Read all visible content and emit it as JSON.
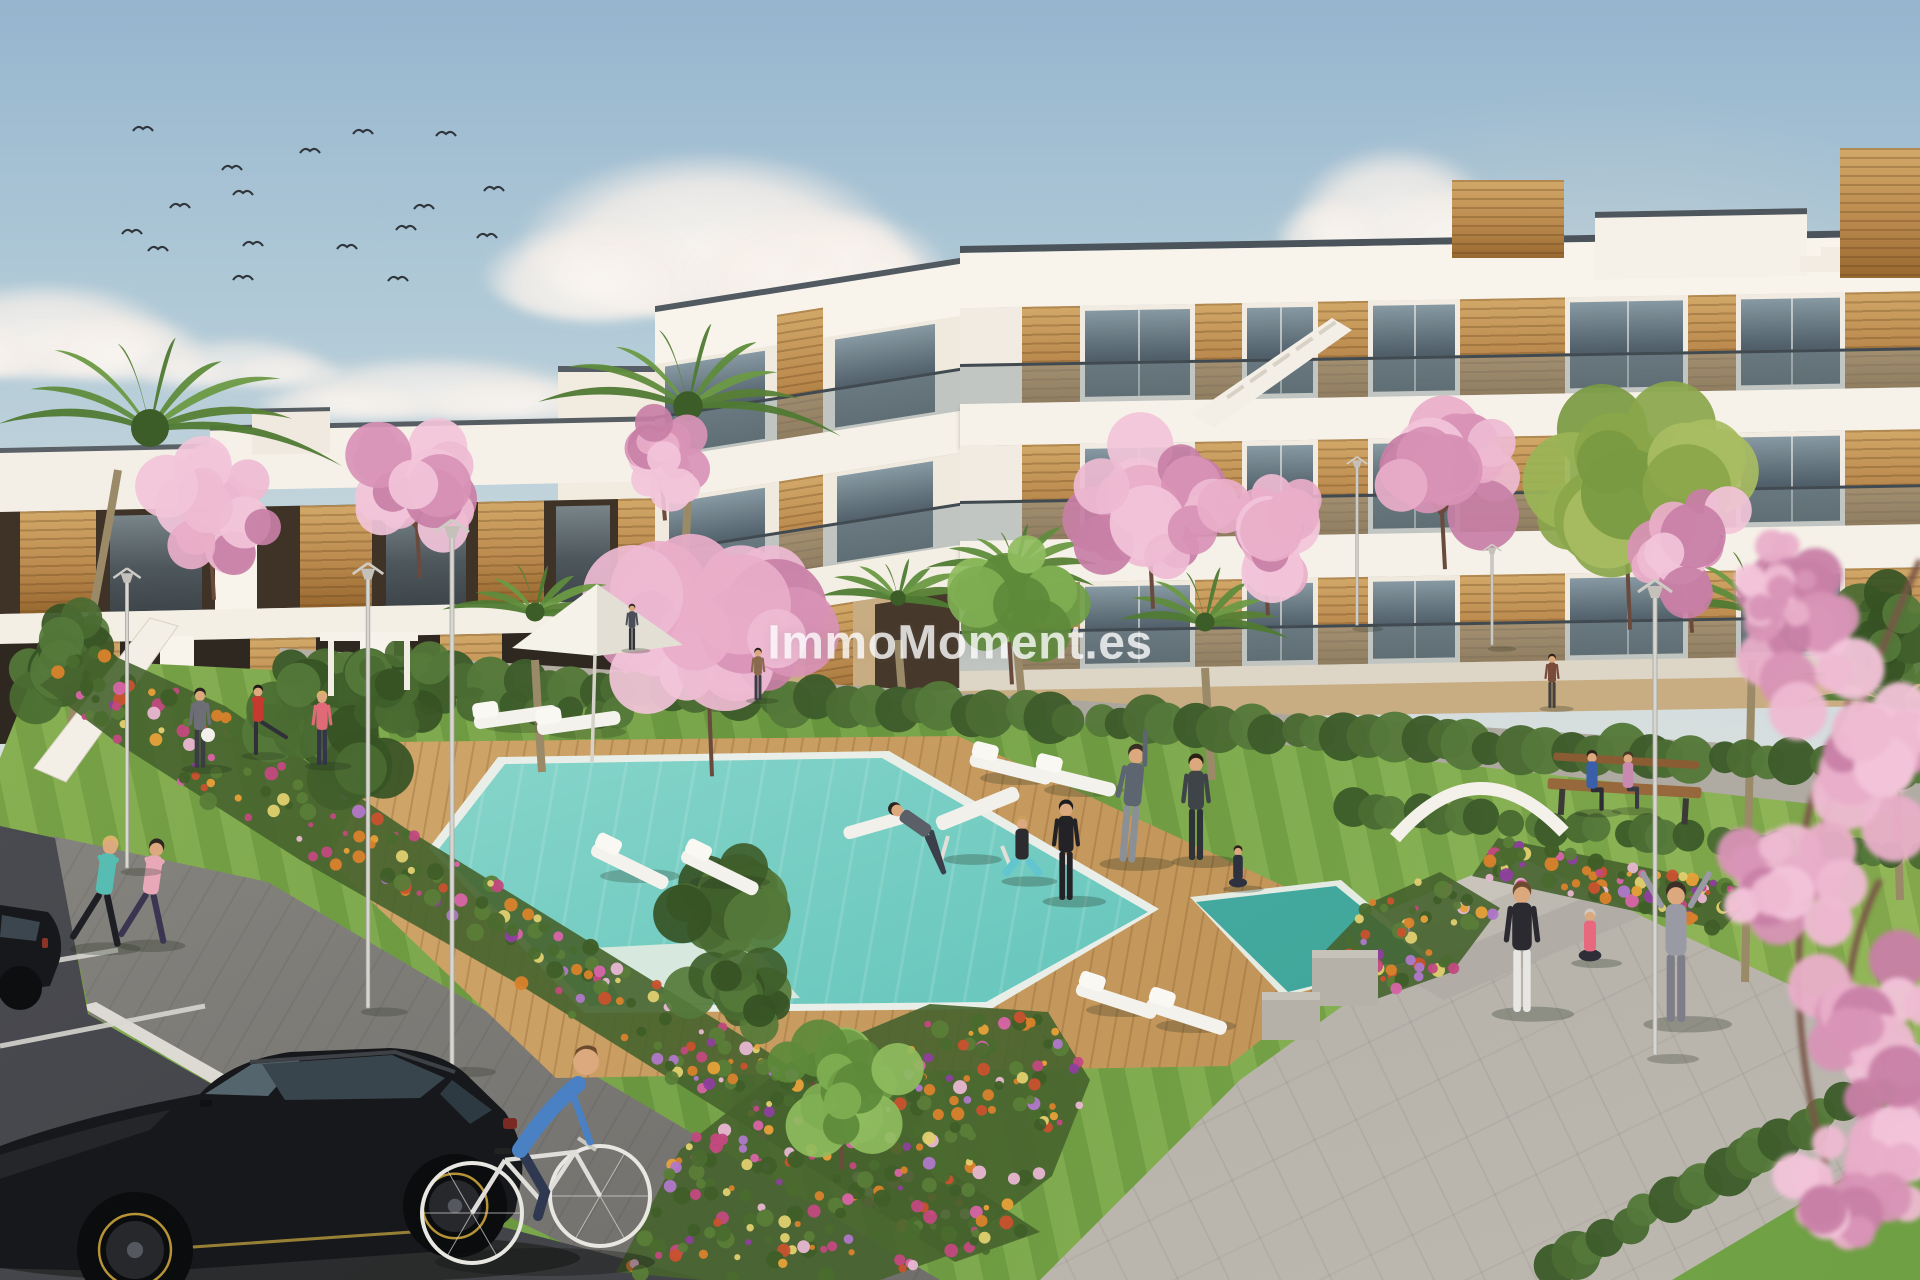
{
  "watermark": {
    "text": "ImmoMoment.es"
  },
  "scene_labels": {
    "setting": "new-build apartment complex render with communal pool and gardens",
    "objects": [
      "apartment-buildings",
      "swimming-pool",
      "wood-deck",
      "sun-loungers",
      "parasol",
      "lawn",
      "flower-beds",
      "cherry-blossom-trees",
      "palm-trees",
      "street-lamps",
      "joggers",
      "cyclist",
      "yoga-group",
      "bench-couple",
      "black-car",
      "parking-lot",
      "birds",
      "clouds"
    ]
  },
  "palette": {
    "sky_top": "#96b5ce",
    "sky_bottom": "#efe9df",
    "building_white": "#f8f4ec",
    "wood": "#bb8a4e",
    "glass": "#51606a",
    "lawn": "#74a246",
    "pool": "#62c4ba",
    "deck": "#c69a5e",
    "path": "#9a9792",
    "asphalt": "#44454a",
    "flower_magenta": "#c2497f",
    "flower_orange": "#d9822b",
    "blossom_pink": "#e9aec9"
  },
  "birds": [
    [
      143,
      128
    ],
    [
      310,
      150
    ],
    [
      363,
      131
    ],
    [
      446,
      133
    ],
    [
      232,
      167
    ],
    [
      180,
      205
    ],
    [
      494,
      188
    ],
    [
      424,
      206
    ],
    [
      243,
      192
    ],
    [
      132,
      231
    ],
    [
      253,
      243
    ],
    [
      347,
      246
    ],
    [
      406,
      227
    ],
    [
      158,
      248
    ],
    [
      487,
      235
    ],
    [
      243,
      277
    ],
    [
      398,
      278
    ]
  ],
  "clouds": [
    {
      "x": 710,
      "y": 235,
      "w": 380,
      "h": 165,
      "o": 0.97
    },
    {
      "x": 45,
      "y": 330,
      "w": 260,
      "h": 95,
      "o": 0.9
    },
    {
      "x": 435,
      "y": 388,
      "w": 300,
      "h": 62,
      "o": 0.8
    },
    {
      "x": 852,
      "y": 258,
      "w": 120,
      "h": 85,
      "o": 0.85
    },
    {
      "x": 1395,
      "y": 208,
      "w": 200,
      "h": 120,
      "o": 0.9
    },
    {
      "x": 240,
      "y": 362,
      "w": 170,
      "h": 48,
      "o": 0.7
    },
    {
      "x": 1060,
      "y": 372,
      "w": 260,
      "h": 50,
      "o": 0.6
    }
  ],
  "palms": [
    {
      "cx": 150,
      "cy": 428,
      "r": 190,
      "trunk": [
        [
          118,
          470
        ],
        [
          96,
          600
        ],
        [
          62,
          770
        ]
      ],
      "layer": "mid"
    },
    {
      "cx": 688,
      "cy": 406,
      "r": 148,
      "trunk": [
        [
          688,
          470
        ],
        [
          688,
          520
        ],
        [
          684,
          560
        ]
      ],
      "layer": "mid"
    },
    {
      "cx": 898,
      "cy": 598,
      "r": 78,
      "trunk": [
        [
          898,
          640
        ],
        [
          900,
          668
        ],
        [
          902,
          690
        ]
      ],
      "layer": "mid"
    },
    {
      "cx": 1015,
      "cy": 570,
      "r": 92,
      "trunk": [
        [
          1015,
          620
        ],
        [
          1018,
          660
        ],
        [
          1022,
          700
        ]
      ],
      "layer": "mid"
    },
    {
      "cx": 1205,
      "cy": 622,
      "r": 95,
      "trunk": [
        [
          1205,
          668
        ],
        [
          1208,
          724
        ],
        [
          1212,
          780
        ]
      ],
      "layer": "mid"
    },
    {
      "cx": 1755,
      "cy": 610,
      "r": 108,
      "trunk": [
        [
          1752,
          660
        ],
        [
          1748,
          820
        ],
        [
          1745,
          982
        ]
      ],
      "layer": "mid"
    },
    {
      "cx": 1895,
      "cy": 705,
      "r": 115,
      "trunk": [
        [
          1895,
          760
        ],
        [
          1898,
          830
        ],
        [
          1900,
          900
        ]
      ],
      "layer": "mid"
    },
    {
      "cx": 535,
      "cy": 612,
      "r": 95,
      "trunk": [
        [
          535,
          660
        ],
        [
          538,
          715
        ],
        [
          542,
          772
        ]
      ],
      "layer": "front"
    }
  ],
  "blossoms": [
    {
      "cx": 214,
      "cy": 510,
      "r": 78,
      "layer": "mid"
    },
    {
      "cx": 420,
      "cy": 486,
      "r": 80,
      "layer": "mid"
    },
    {
      "cx": 665,
      "cy": 456,
      "r": 56,
      "layer": "mid"
    },
    {
      "cx": 1153,
      "cy": 503,
      "r": 92,
      "layer": "mid"
    },
    {
      "cx": 1268,
      "cy": 528,
      "r": 76,
      "layer": "mid"
    },
    {
      "cx": 1445,
      "cy": 468,
      "r": 88,
      "layer": "mid"
    },
    {
      "cx": 1692,
      "cy": 543,
      "r": 78,
      "layer": "mid"
    },
    {
      "cx": 712,
      "cy": 636,
      "r": 122,
      "layer": "front"
    }
  ],
  "fg_blossoms": [
    {
      "cx": 1810,
      "cy": 640,
      "r": 92
    },
    {
      "cx": 1878,
      "cy": 762,
      "r": 104
    },
    {
      "cx": 1788,
      "cy": 905,
      "r": 88
    },
    {
      "cx": 1862,
      "cy": 1012,
      "r": 98
    },
    {
      "cx": 1905,
      "cy": 1140,
      "r": 95
    },
    {
      "cx": 1830,
      "cy": 1208,
      "r": 82
    },
    {
      "cx": 1772,
      "cy": 585,
      "r": 55
    }
  ],
  "green_trees": [
    {
      "cx": 1630,
      "cy": 494,
      "r": 118,
      "shade": "yellow",
      "layer": "mid"
    },
    {
      "cx": 1012,
      "cy": 597,
      "r": 76,
      "shade": "light",
      "layer": "mid"
    },
    {
      "cx": 842,
      "cy": 1082,
      "r": 76,
      "shade": "light",
      "layer": "front"
    },
    {
      "cx": 330,
      "cy": 736,
      "r": 88,
      "shade": "dark",
      "layer": "front"
    },
    {
      "cx": 398,
      "cy": 688,
      "r": 58,
      "shade": "dark",
      "layer": "front"
    },
    {
      "cx": 728,
      "cy": 898,
      "r": 80,
      "shade": "dark",
      "layer": "front"
    },
    {
      "cx": 738,
      "cy": 990,
      "r": 66,
      "shade": "dark",
      "layer": "front"
    },
    {
      "cx": 60,
      "cy": 660,
      "r": 70,
      "shade": "dark",
      "layer": "mid"
    },
    {
      "cx": 1880,
      "cy": 640,
      "r": 72,
      "shade": "dark",
      "layer": "mid"
    }
  ],
  "hedges": [
    {
      "x1": 295,
      "y1": 668,
      "x2": 1920,
      "y2": 772,
      "r": 21,
      "n": 66
    },
    {
      "x1": 1350,
      "y1": 810,
      "x2": 1920,
      "y2": 858,
      "r": 16,
      "n": 26
    },
    {
      "x1": 1552,
      "y1": 1268,
      "x2": 1880,
      "y2": 1082,
      "r": 20,
      "n": 18
    },
    {
      "x1": 380,
      "y1": 700,
      "x2": 620,
      "y2": 716,
      "r": 14,
      "n": 12
    }
  ],
  "lamps": [
    {
      "x": 127,
      "top": 562,
      "bot": 868,
      "s": 0.8,
      "layer": "front"
    },
    {
      "x": 368,
      "top": 556,
      "bot": 1008,
      "s": 0.9,
      "layer": "front"
    },
    {
      "x": 452,
      "top": 512,
      "bot": 1068,
      "s": 1.0,
      "layer": "front"
    },
    {
      "x": 1357,
      "top": 452,
      "bot": 625,
      "s": 0.6,
      "layer": "mid"
    },
    {
      "x": 1492,
      "top": 540,
      "bot": 645,
      "s": 0.55,
      "layer": "mid"
    },
    {
      "x": 1655,
      "top": 572,
      "bot": 1055,
      "s": 1.0,
      "layer": "front"
    }
  ],
  "loungers": [
    {
      "x": 515,
      "y": 712,
      "rot": -8
    },
    {
      "x": 578,
      "y": 718,
      "rot": -8
    },
    {
      "x": 1012,
      "y": 764,
      "rot": 14
    },
    {
      "x": 1076,
      "y": 776,
      "rot": 14
    },
    {
      "x": 632,
      "y": 862,
      "rot": 26
    },
    {
      "x": 722,
      "y": 868,
      "rot": 26
    },
    {
      "x": 1118,
      "y": 996,
      "rot": 18
    },
    {
      "x": 1188,
      "y": 1012,
      "rot": 18
    }
  ],
  "flowerbeds": [
    {
      "name": "bed-left",
      "count": 270,
      "poly": [
        [
          92,
          646
        ],
        [
          225,
          706
        ],
        [
          405,
          828
        ],
        [
          765,
          1050
        ],
        [
          1040,
          1232
        ],
        [
          955,
          1262
        ],
        [
          760,
          1135
        ],
        [
          520,
          985
        ],
        [
          300,
          860
        ],
        [
          120,
          745
        ],
        [
          40,
          685
        ]
      ]
    },
    {
      "name": "bed-center",
      "count": 250,
      "poly": [
        [
          616,
          1272
        ],
        [
          680,
          1150
        ],
        [
          790,
          1062
        ],
        [
          930,
          1004
        ],
        [
          1048,
          1012
        ],
        [
          1090,
          1080
        ],
        [
          1052,
          1176
        ],
        [
          950,
          1255
        ],
        [
          880,
          1280
        ],
        [
          700,
          1280
        ]
      ]
    },
    {
      "name": "bed-steps",
      "count": 60,
      "poly": [
        [
          1318,
          958
        ],
        [
          1372,
          902
        ],
        [
          1440,
          872
        ],
        [
          1500,
          908
        ],
        [
          1452,
          972
        ],
        [
          1368,
          1002
        ]
      ]
    },
    {
      "name": "bed-right",
      "count": 90,
      "poly": [
        [
          1498,
          838
        ],
        [
          1758,
          890
        ],
        [
          1722,
          930
        ],
        [
          1472,
          876
        ]
      ]
    }
  ],
  "people": [
    {
      "x": 96,
      "y": 947,
      "h": 112,
      "pose": "run",
      "shirt": "#57bdb2",
      "pants": "#1e1f24",
      "hair": "#d8b36a"
    },
    {
      "x": 143,
      "y": 944,
      "h": 106,
      "pose": "run",
      "shirt": "#e9a8b8",
      "pants": "#3a3550",
      "hair": "#2e2620"
    },
    {
      "x": 200,
      "y": 768,
      "h": 80,
      "pose": "stand",
      "shirt": "#6e6e76",
      "pants": "#3c3c44",
      "hair": "#2a2420"
    },
    {
      "x": 258,
      "y": 755,
      "h": 70,
      "pose": "kick",
      "shirt": "#c5392e",
      "pants": "#2f3038",
      "hair": "#1e1a16"
    },
    {
      "x": 322,
      "y": 765,
      "h": 74,
      "pose": "stand",
      "shirt": "#e06a78",
      "pants": "#34344a",
      "hair": "#d8b36a"
    },
    {
      "x": 1022,
      "y": 880,
      "h": 88,
      "pose": "squat",
      "shirt": "#2c2c30",
      "pants": "#63c6ce",
      "hair": "#c9a05e"
    },
    {
      "x": 1066,
      "y": 900,
      "h": 100,
      "pose": "stand",
      "shirt": "#232327",
      "pants": "#232327",
      "hair": "#1c1c20"
    },
    {
      "x": 1127,
      "y": 862,
      "h": 118,
      "pose": "stretch",
      "shirt": "#5d6570",
      "pants": "#8b8f96",
      "hair": "#3a3026"
    },
    {
      "x": 1196,
      "y": 860,
      "h": 106,
      "pose": "stand",
      "shirt": "#3f4449",
      "pants": "#2e3338",
      "hair": "#2a2018"
    },
    {
      "x": 1238,
      "y": 888,
      "h": 64,
      "pose": "cross",
      "shirt": "#2e3240",
      "pants": "#2e3240",
      "hair": "#2c2118"
    },
    {
      "x": 1552,
      "y": 708,
      "h": 54,
      "pose": "stand",
      "shirt": "#7a4a3a",
      "pants": "#44403c",
      "hair": "#2c2118"
    },
    {
      "x": 1592,
      "y": 812,
      "h": 74,
      "pose": "sit",
      "shirt": "#3a5fa8",
      "pants": "#2c2c34",
      "hair": "#2c2118"
    },
    {
      "x": 1628,
      "y": 810,
      "h": 70,
      "pose": "sit",
      "shirt": "#c88ab0",
      "pants": "#3a3a44",
      "hair": "#4a3626"
    },
    {
      "x": 1522,
      "y": 1012,
      "h": 130,
      "pose": "stand",
      "shirt": "#2a2a30",
      "pants": "#e8e6e2",
      "hair": "#6b4a2e"
    },
    {
      "x": 1590,
      "y": 962,
      "h": 80,
      "pose": "cross",
      "shirt": "#e8697e",
      "pants": "#2e2e38",
      "hair": "#cfc9c2"
    },
    {
      "x": 1676,
      "y": 1022,
      "h": 140,
      "pose": "armsup",
      "shirt": "#9a9aa4",
      "pants": "#7e7e8a",
      "hair": "#3a3026"
    },
    {
      "x": 632,
      "y": 650,
      "h": 46,
      "pose": "stand",
      "shirt": "#4a4e58",
      "pants": "#33343a",
      "hair": "#2a2420"
    },
    {
      "x": 758,
      "y": 700,
      "h": 52,
      "pose": "stand",
      "shirt": "#8a6a4e",
      "pants": "#3c3c44",
      "hair": "#2a2420"
    },
    {
      "x": 965,
      "y": 858,
      "h": 92,
      "pose": "lounge",
      "shirt": "#5a5f68",
      "pants": "#3a3f4a",
      "hair": "#2a2420"
    }
  ],
  "ball": {
    "x": 208,
    "y": 735,
    "r": 7
  },
  "umbrella": {
    "apex": [
      597,
      584
    ],
    "left": [
      512,
      648
    ],
    "right": [
      683,
      645
    ],
    "poleBot": 762
  },
  "bench": {
    "x": 1548,
    "y": 778,
    "w": 154,
    "rot": 3.5
  },
  "canopy": {
    "path": "M1395,838 Q1478,742 1564,832"
  },
  "pergola": {
    "x1": 328,
    "x2": 404,
    "topY": 632,
    "botY": 696
  },
  "stair_ramp": [
    [
      150,
      618
    ],
    [
      178,
      626
    ],
    [
      66,
      782
    ],
    [
      34,
      768
    ]
  ],
  "wall_blocks": [
    {
      "x": 1312,
      "y": 950,
      "w": 66,
      "h": 56
    },
    {
      "x": 1262,
      "y": 992,
      "w": 58,
      "h": 48
    }
  ],
  "stall_lines": [
    [
      0,
      970,
      118,
      950
    ],
    [
      0,
      1046,
      205,
      1006
    ],
    [
      28,
      1140,
      330,
      1068
    ],
    [
      140,
      1262,
      470,
      1140
    ]
  ],
  "windows_main": [
    [
      125,
      230
    ],
    [
      287,
      353
    ],
    [
      413,
      495
    ],
    [
      610,
      723
    ],
    [
      781,
      880
    ]
  ],
  "piers_main": [
    [
      62,
      120
    ],
    [
      235,
      282
    ],
    [
      358,
      408
    ],
    [
      500,
      605
    ],
    [
      728,
      776
    ],
    [
      885,
      960
    ]
  ]
}
